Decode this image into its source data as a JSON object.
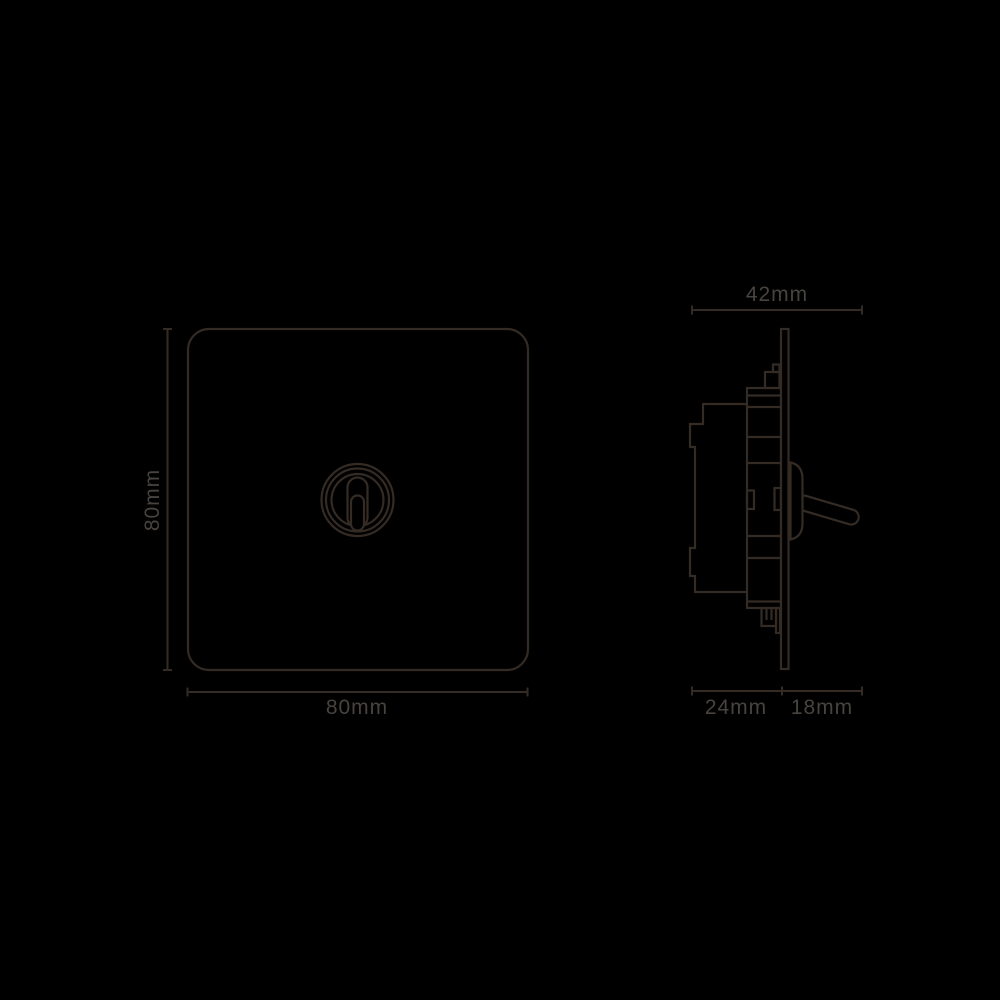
{
  "page": {
    "background_color": "#000000",
    "line_color": "#342b24",
    "label_color": "#48433f"
  },
  "drawing": {
    "subject": "toggle-switch-dimension-drawing",
    "front_view": {
      "height_dim": "80mm",
      "width_dim": "80mm"
    },
    "side_view": {
      "width_dim": "42mm",
      "box_depth_dim": "24mm",
      "toggle_depth_dim": "18mm"
    }
  }
}
